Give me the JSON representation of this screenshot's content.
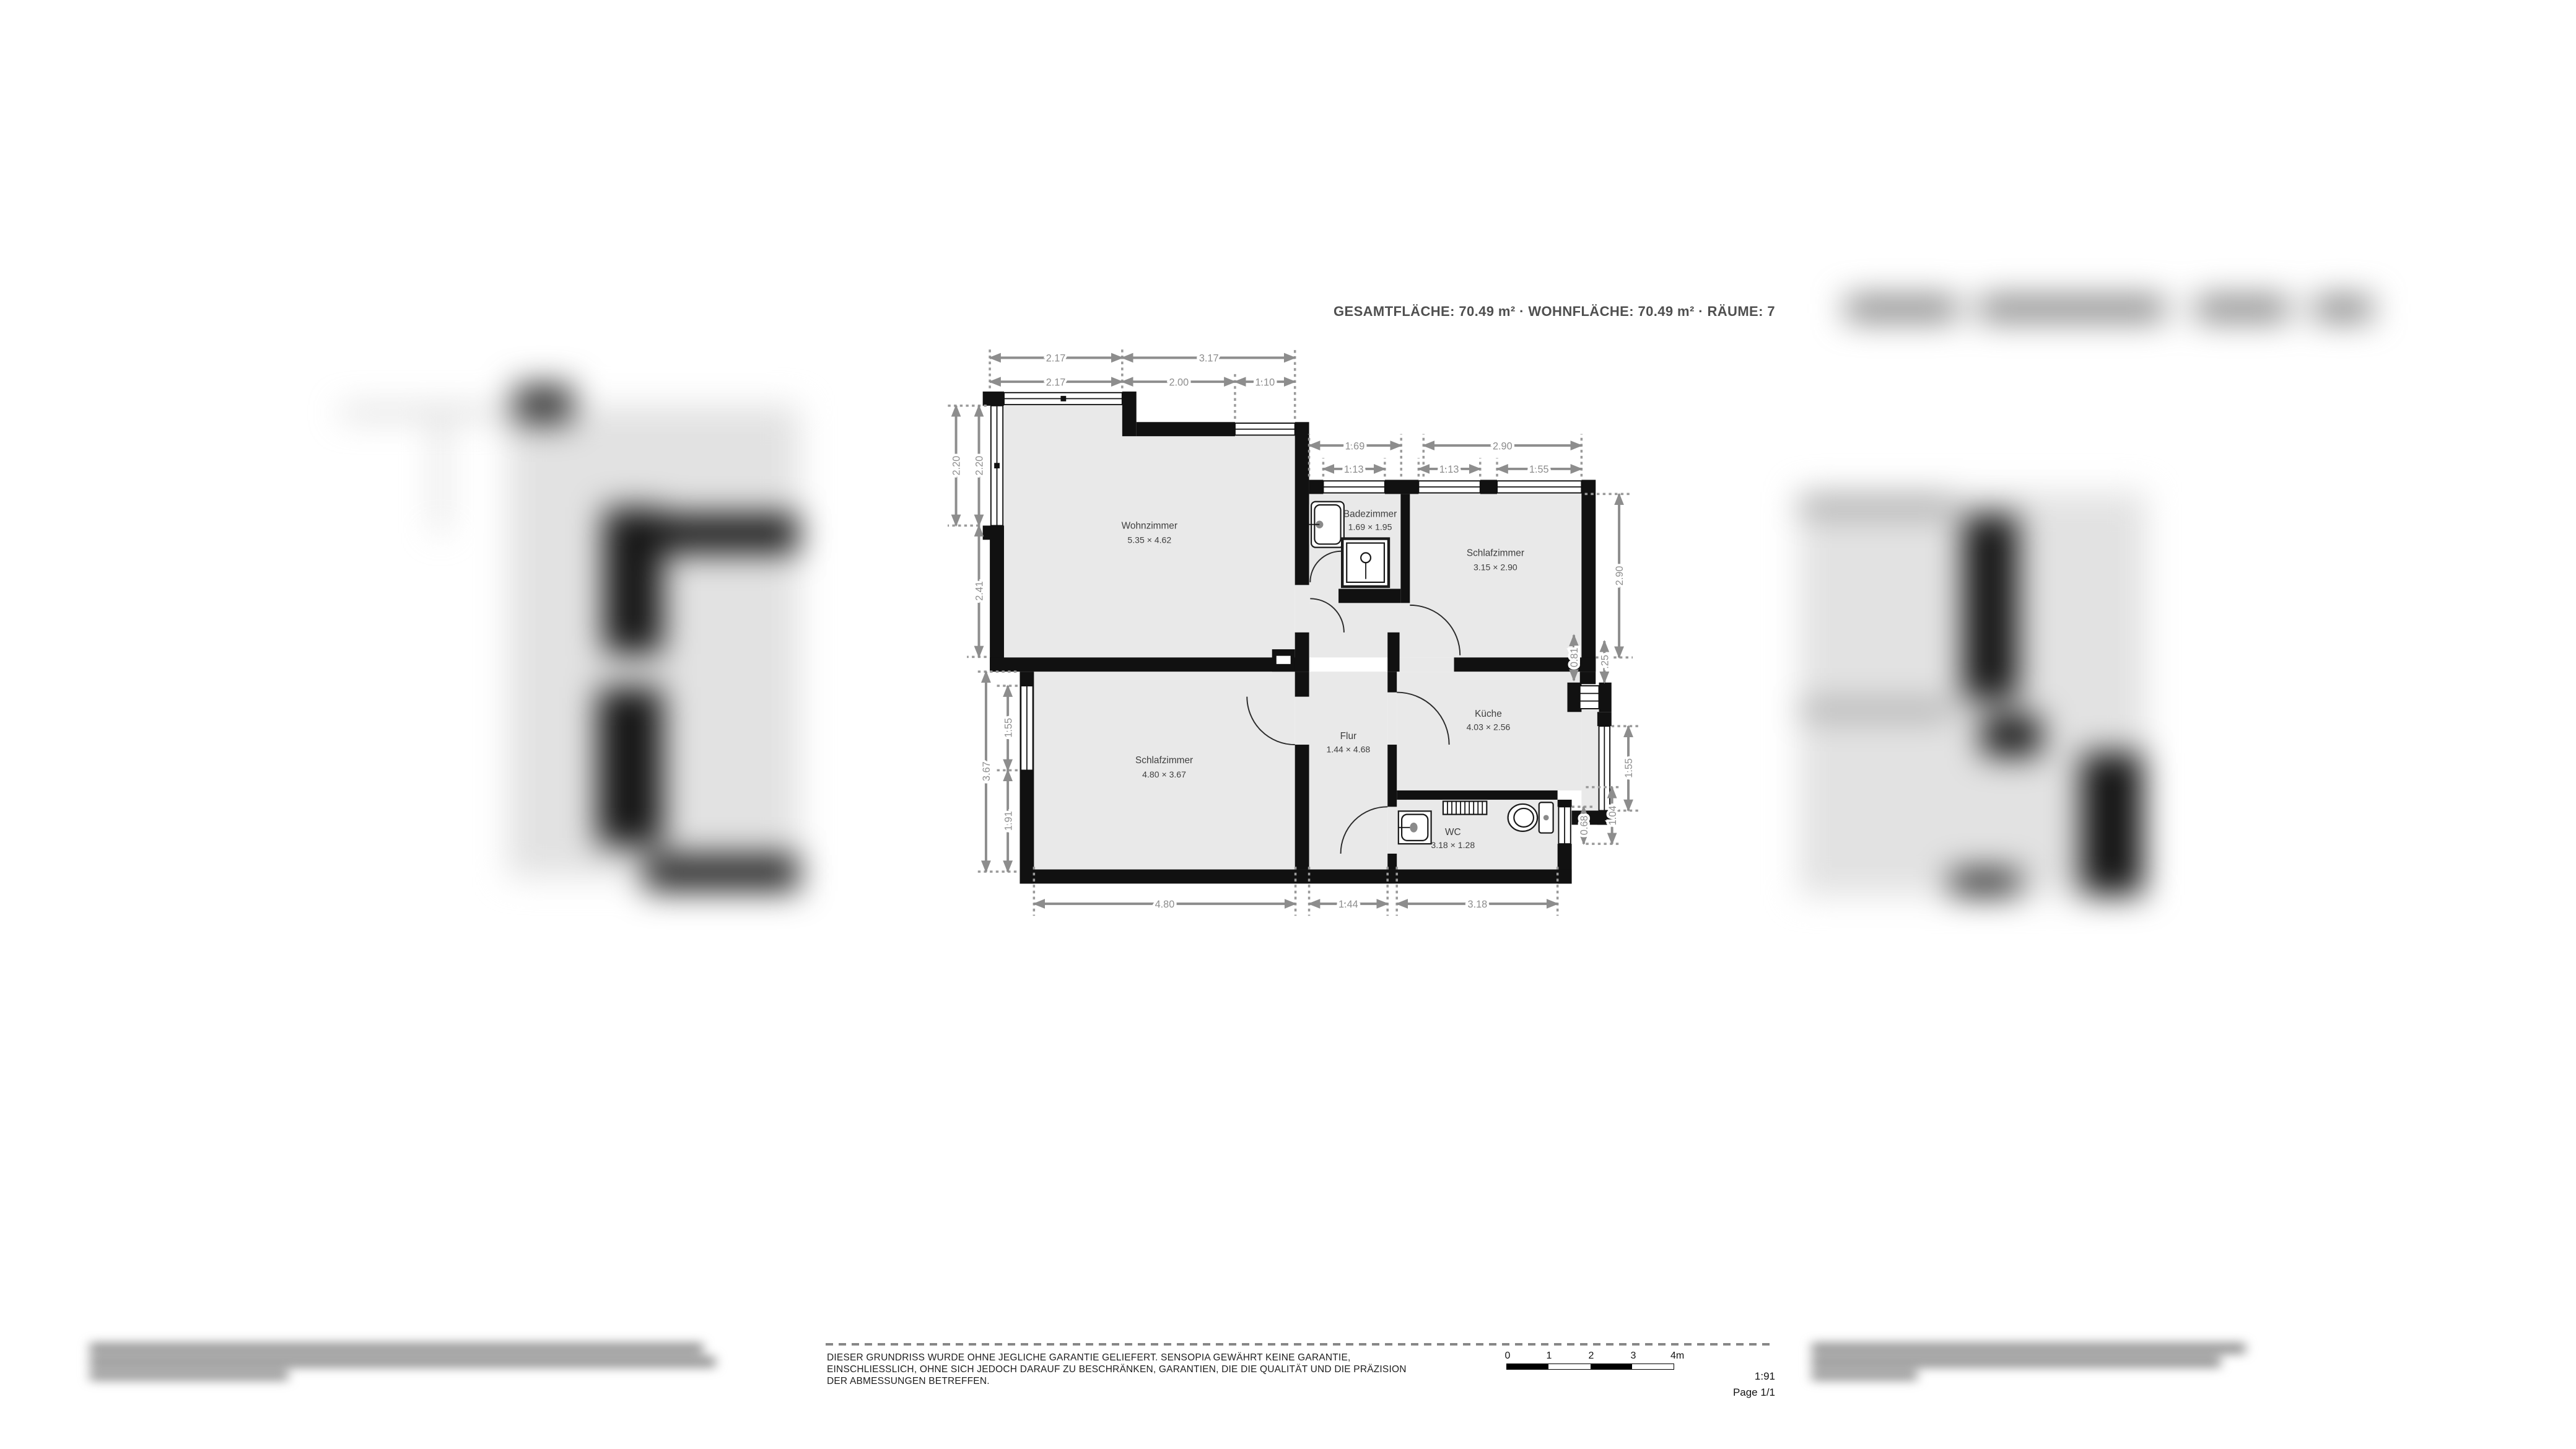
{
  "header": {
    "summary": "GESAMTFLÄCHE: 70.49 m² · WOHNFLÄCHE: 70.49 m² · RÄUME: 7"
  },
  "plan": {
    "rooms": [
      {
        "name": "Wohnzimmer",
        "size": "5.35 × 4.62"
      },
      {
        "name": "Badezimmer",
        "size": "1.69 × 1.95"
      },
      {
        "name": "Schlafzimmer",
        "size": "3.15 × 2.90"
      },
      {
        "name": "Schlafzimmer",
        "size": "4.80 × 3.67"
      },
      {
        "name": "Flur",
        "size": "1.44 × 4.68"
      },
      {
        "name": "Küche",
        "size": "4.03 × 2.56"
      },
      {
        "name": "WC",
        "size": "3.18 × 1.28"
      }
    ],
    "dims": {
      "top_outer": [
        "2.17",
        "3.17"
      ],
      "top_inner": [
        "2.17",
        "2.00",
        "1.10"
      ],
      "mid_top_outer": [
        "1.69",
        "2.90"
      ],
      "mid_top_inner": [
        "1.13",
        "1.13",
        "1.55"
      ],
      "left_upper_outer": "2.20",
      "left_upper_inner": [
        "2.20",
        "2.41"
      ],
      "left_lower_outer": "3.67",
      "left_lower_inner": [
        "1.55",
        "1.91"
      ],
      "right": [
        "2.90",
        "0.81",
        ".25",
        "1.55",
        "0.68",
        "1.04"
      ],
      "bottom": [
        "4.80",
        "1.44",
        "3.18"
      ]
    }
  },
  "footer": {
    "disclaimer": [
      "DIESER GRUNDRISS WURDE OHNE JEGLICHE GARANTIE GELIEFERT. SENSOPIA GEWÄHRT KEINE GARANTIE,",
      "EINSCHLIESSLICH, OHNE SICH JEDOCH DARAUF ZU BESCHRÄNKEN, GARANTIEN, DIE DIE QUALITÄT UND DIE PRÄZISION",
      "DER ABMESSUNGEN BETREFFEN."
    ],
    "scale_ticks": [
      "0",
      "1",
      "2",
      "3",
      "4m"
    ],
    "scale_ratio": "1:91",
    "page": "Page 1/1"
  }
}
